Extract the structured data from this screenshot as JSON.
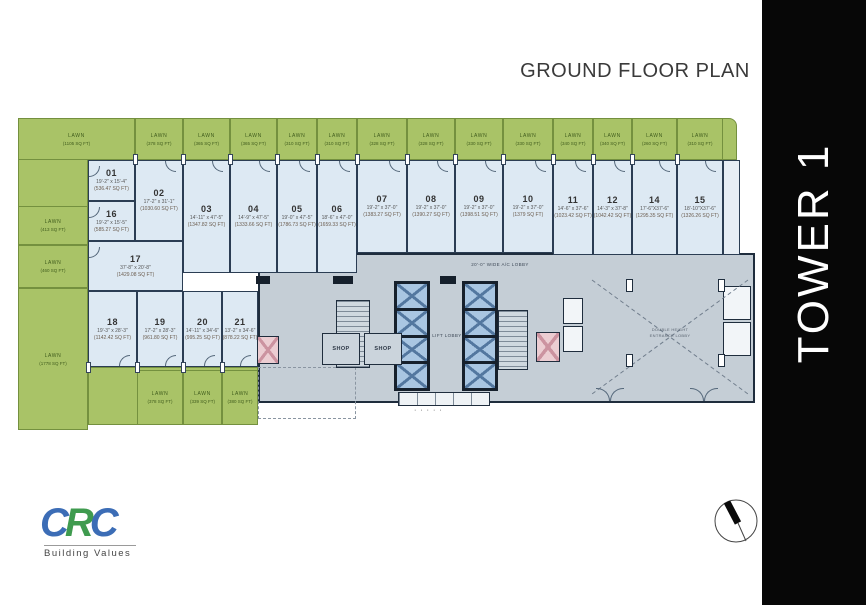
{
  "header": {
    "title": "GROUND FLOOR PLAN"
  },
  "tower": {
    "label": "TOWER 1"
  },
  "logo": {
    "letters": [
      {
        "ch": "C",
        "color": "#3c6db6"
      },
      {
        "ch": "R",
        "color": "#3f9b4f"
      },
      {
        "ch": "C",
        "color": "#3c6db6"
      }
    ],
    "tagline": "Building Values"
  },
  "palette": {
    "lawn_green": "#a9c367",
    "unit_blue": "#dde9f3",
    "core_gray": "#c5ced6",
    "wall_dark": "#1f2d3d",
    "band_black": "#070707"
  },
  "core": {
    "lobby_label": "20'-0\" WIDE A/C LOBBY",
    "lift_lobby_label": "LIFT LOBBY",
    "shops": [
      "SHOP",
      "SHOP"
    ],
    "hall_line1": "DOUBLE HEIGHT",
    "hall_line2": "ENTRANCE LOBBY"
  },
  "plan": {
    "units": [
      {
        "num": "01",
        "dim": "19'-2\" x 15'-4\"",
        "area": "(536.47 SQ FT)",
        "rect": [
          88,
          160,
          47,
          41
        ],
        "door": "left"
      },
      {
        "num": "16",
        "dim": "19'-2\" x 15'-5\"",
        "area": "(585.27 SQ FT)",
        "rect": [
          88,
          201,
          47,
          40
        ],
        "door": "left"
      },
      {
        "num": "02",
        "dim": "17'-2\" x 31'-1\"",
        "area": "(1030.60 SQ FT)",
        "rect": [
          135,
          160,
          48,
          81
        ],
        "door": "top"
      },
      {
        "num": "17",
        "dim": "37'-8\" x 20'-8\"",
        "area": "(1429.08 SQ FT)",
        "rect": [
          88,
          241,
          95,
          50
        ],
        "door": "left"
      },
      {
        "num": "03",
        "dim": "14'-11\" x 47'-5\"",
        "area": "(1347.82 SQ FT)",
        "rect": [
          183,
          160,
          47,
          113
        ],
        "door": "top"
      },
      {
        "num": "04",
        "dim": "14'-9\" x 47'-5\"",
        "area": "(1333.66 SQ FT)",
        "rect": [
          230,
          160,
          47,
          113
        ],
        "door": "top"
      },
      {
        "num": "05",
        "dim": "19'-0\" x 47'-5\"",
        "area": "(1786.73 SQ FT)",
        "rect": [
          277,
          160,
          40,
          113
        ],
        "door": "top"
      },
      {
        "num": "06",
        "dim": "18'-6\" x 47'-0\"",
        "area": "(1659.33 SQ FT)",
        "rect": [
          317,
          160,
          40,
          113
        ],
        "door": "top"
      },
      {
        "num": "07",
        "dim": "19'-2\" x 37'-0\"",
        "area": "(1383.27 SQ FT)",
        "rect": [
          357,
          160,
          50,
          93
        ],
        "door": "top"
      },
      {
        "num": "08",
        "dim": "19'-2\" x 37'-0\"",
        "area": "(1390.27 SQ FT)",
        "rect": [
          407,
          160,
          48,
          93
        ],
        "door": "top"
      },
      {
        "num": "09",
        "dim": "19'-2\" x 37'-0\"",
        "area": "(1398.51 SQ FT)",
        "rect": [
          455,
          160,
          48,
          93
        ],
        "door": "top"
      },
      {
        "num": "10",
        "dim": "19'-2\" x 37'-0\"",
        "area": "(1379 SQ FT)",
        "rect": [
          503,
          160,
          50,
          93
        ],
        "door": "top"
      },
      {
        "num": "11",
        "dim": "14'-6\" x 37'-6\"",
        "area": "(1023.42 SQ FT)",
        "rect": [
          553,
          160,
          40,
          95
        ],
        "door": "top"
      },
      {
        "num": "12",
        "dim": "14'-3\" x 37'-8\"",
        "area": "(1042.42 SQ FT)",
        "rect": [
          593,
          160,
          39,
          95
        ],
        "door": "top"
      },
      {
        "num": "14",
        "dim": "17'-6\"X37'-6\"",
        "area": "(1295.35 SQ FT)",
        "rect": [
          632,
          160,
          45,
          95
        ],
        "door": "top"
      },
      {
        "num": "15",
        "dim": "18'-10\"X37'-6\"",
        "area": "(1326.26 SQ FT)",
        "rect": [
          677,
          160,
          46,
          95
        ],
        "door": "top"
      },
      {
        "num": "18",
        "dim": "19'-3\" x 28'-3\"",
        "area": "(1142.42 SQ FT)",
        "rect": [
          88,
          291,
          49,
          76
        ],
        "door": "bottom"
      },
      {
        "num": "19",
        "dim": "17'-2\" x 28'-3\"",
        "area": "(961.80 SQ FT)",
        "rect": [
          137,
          291,
          46,
          76
        ],
        "door": "bottom"
      },
      {
        "num": "20",
        "dim": "14'-11\" x 34'-6\"",
        "area": "(995.25 SQ FT)",
        "rect": [
          183,
          291,
          39,
          76
        ],
        "door": "bottom"
      },
      {
        "num": "21",
        "dim": "13'-2\" x 34'-6\"",
        "area": "(878.22 SQ FT)",
        "rect": [
          222,
          291,
          36,
          76
        ],
        "door": "bottom"
      }
    ],
    "lawns": [
      {
        "label": "LAWN",
        "area": "(1105 SQ FT)",
        "rect": [
          18,
          118,
          117,
          42
        ],
        "noborder": false
      },
      {
        "label": "LAWN",
        "area": "(378 SQ FT)",
        "rect": [
          135,
          118,
          48,
          42
        ]
      },
      {
        "label": "LAWN",
        "area": "(365 SQ FT)",
        "rect": [
          183,
          118,
          47,
          42
        ]
      },
      {
        "label": "LAWN",
        "area": "(365 SQ FT)",
        "rect": [
          230,
          118,
          47,
          42
        ]
      },
      {
        "label": "LAWN",
        "area": "(310 SQ FT)",
        "rect": [
          277,
          118,
          40,
          42
        ]
      },
      {
        "label": "LAWN",
        "area": "(310 SQ FT)",
        "rect": [
          317,
          118,
          40,
          42
        ]
      },
      {
        "label": "LAWN",
        "area": "(328 SQ FT)",
        "rect": [
          357,
          118,
          50,
          42
        ]
      },
      {
        "label": "LAWN",
        "area": "(328 SQ FT)",
        "rect": [
          407,
          118,
          48,
          42
        ]
      },
      {
        "label": "LAWN",
        "area": "(330 SQ FT)",
        "rect": [
          455,
          118,
          48,
          42
        ]
      },
      {
        "label": "LAWN",
        "area": "(330 SQ FT)",
        "rect": [
          503,
          118,
          50,
          42
        ]
      },
      {
        "label": "LAWN",
        "area": "(340 SQ FT)",
        "rect": [
          553,
          118,
          40,
          42
        ]
      },
      {
        "label": "LAWN",
        "area": "(340 SQ FT)",
        "rect": [
          593,
          118,
          39,
          42
        ]
      },
      {
        "label": "LAWN",
        "area": "(260 SQ FT)",
        "rect": [
          632,
          118,
          45,
          42
        ]
      },
      {
        "label": "LAWN",
        "area": "(310 SQ FT)",
        "rect": [
          677,
          118,
          46,
          42
        ]
      },
      {
        "label": "LAWN",
        "area": "(413 SQ FT)",
        "rect": [
          18,
          206,
          70,
          39
        ]
      },
      {
        "label": "LAWN",
        "area": "(460 SQ FT)",
        "rect": [
          18,
          245,
          70,
          43
        ]
      },
      {
        "label": "LAWN",
        "area": "(1778 SQ FT)",
        "rect": [
          18,
          288,
          70,
          142
        ]
      },
      {
        "label": "LAWN",
        "area": "(378 SQ FT)",
        "rect": [
          137,
          370,
          46,
          55
        ]
      },
      {
        "label": "LAWN",
        "area": "(339 SQ FT)",
        "rect": [
          183,
          370,
          39,
          55
        ]
      },
      {
        "label": "LAWN",
        "area": "(380 SQ FT)",
        "rect": [
          222,
          370,
          36,
          55
        ]
      }
    ]
  }
}
